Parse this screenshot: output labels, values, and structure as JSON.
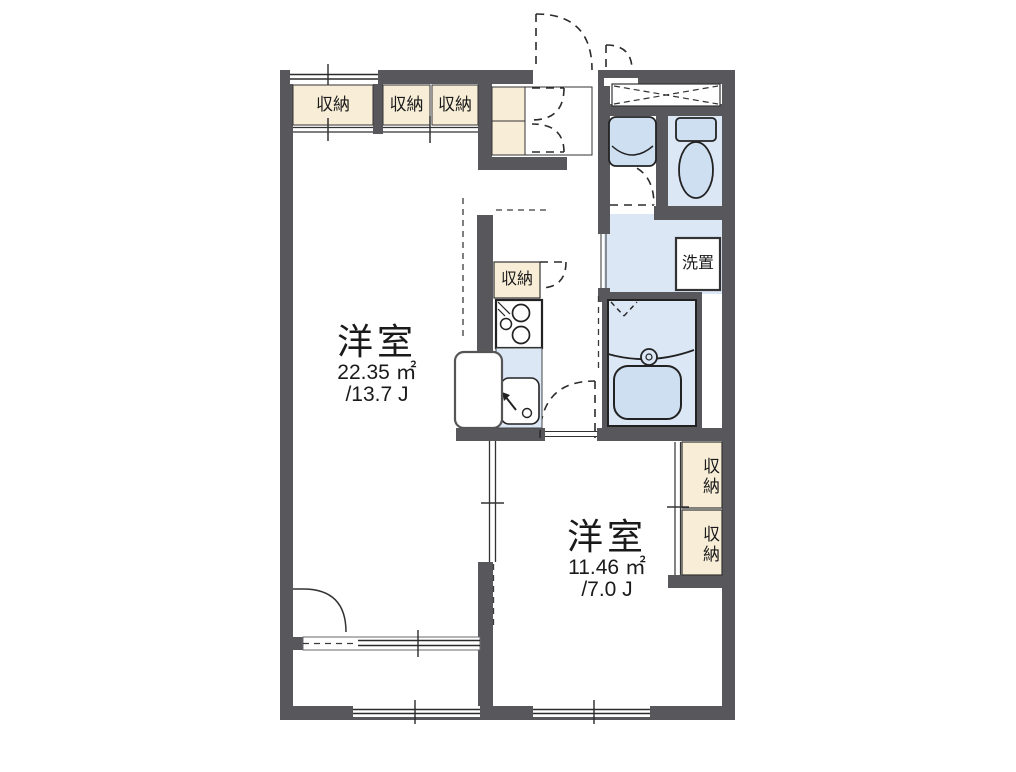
{
  "floor_plan": {
    "rooms": [
      {
        "name": "洋室",
        "area_m2": "22.35 ㎡",
        "area_tatami": "/13.7 J"
      },
      {
        "name": "洋室",
        "area_m2": "11.46 ㎡",
        "area_tatami": "/7.0 J"
      }
    ],
    "storage_label": "収納",
    "storage_count": 6,
    "washer_label": "洗置",
    "fixtures": [
      "entrance-door",
      "shoe-cabinet",
      "toilet",
      "washbasin",
      "bathtub",
      "washer-space",
      "kitchen-stove",
      "kitchen-sink",
      "refrigerator-space",
      "balcony"
    ],
    "colors": {
      "wall": "#58585c",
      "closet": "#f8eed8",
      "wet": "#dce7f6",
      "fixture": "#cfdff2",
      "line": "#2b2b2b",
      "bg": "#ffffff"
    }
  }
}
